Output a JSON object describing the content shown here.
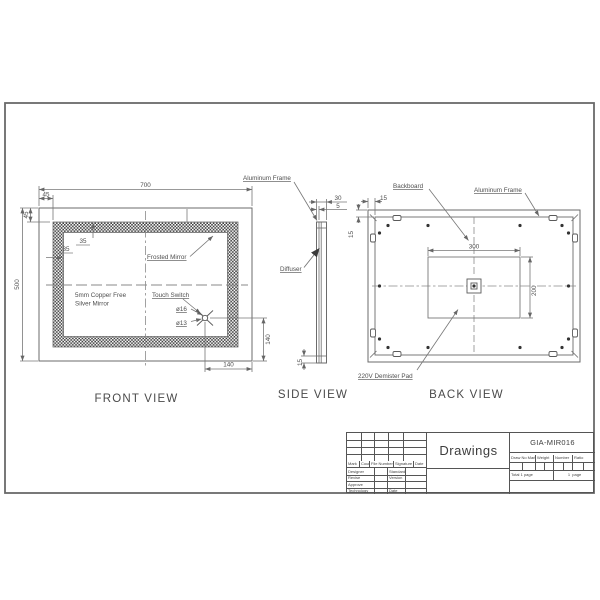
{
  "front_view": {
    "title": "FRONT VIEW",
    "dims": {
      "width": "700",
      "height": "500",
      "offset_h": "45",
      "offset_v": "45",
      "band_v": "35",
      "band_h": "35",
      "switch_v": "140",
      "switch_h": "140"
    },
    "labels": {
      "frosted": "Frosted Mirror",
      "mirror_line1": "5mm Copper Free",
      "mirror_line2": "Silver Mirror",
      "touch": "Touch Switch",
      "dia16": "ø16",
      "dia13": "ø13"
    }
  },
  "side_view": {
    "title": "SIDE VIEW",
    "dims": {
      "depth": "30",
      "glass": "5",
      "lip": "15"
    },
    "labels": {
      "frame": "Aluminum Frame",
      "diffuser": "Diffuser"
    }
  },
  "back_view": {
    "title": "BACK VIEW",
    "dims": {
      "border_h": "15",
      "border_v": "15",
      "pad_w": "300",
      "pad_h": "200"
    },
    "labels": {
      "backboard": "Backboard",
      "frame": "Aluminum Frame",
      "pad": "220V Demister Pad"
    }
  },
  "title_block": {
    "drawings": "Drawings",
    "model": "GIA-MIR016",
    "col_headers": [
      "Draw No Mark",
      "Weight",
      "Number",
      "Ratio"
    ],
    "total": "Total",
    "total_pages": "1",
    "page_word": "page",
    "page_num": "1",
    "page_word2": "page",
    "left_headers": [
      "Mark",
      "Count",
      "File Number",
      "Signature",
      "Date"
    ],
    "row_labels": [
      "Designer",
      "Revise",
      "Approve",
      "Technology"
    ],
    "row_values": [
      "Standard",
      "Version",
      "",
      "Date"
    ]
  }
}
